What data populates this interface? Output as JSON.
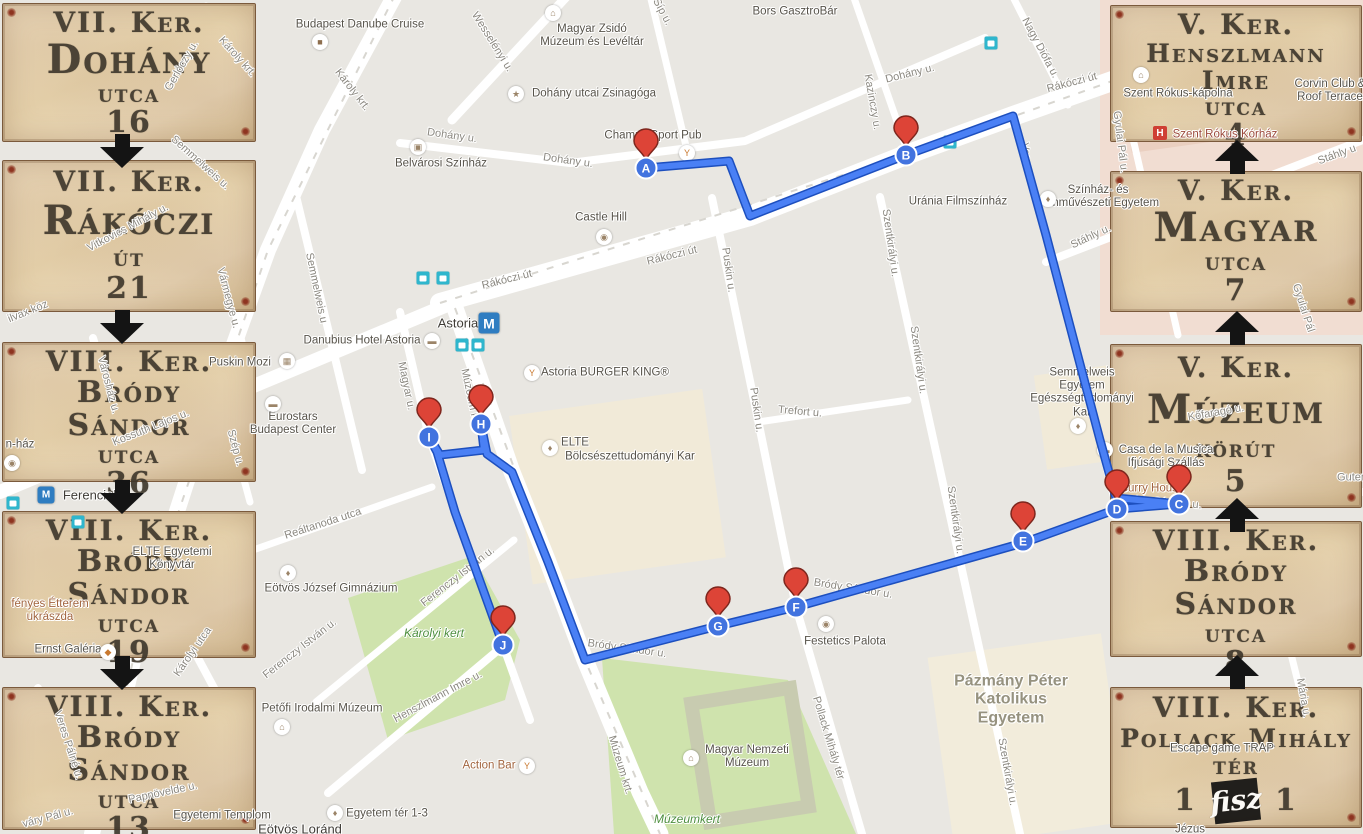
{
  "route": {
    "color": "#4a80f5",
    "casing_color": "#1d4fbe",
    "points": [
      [
        646,
        168
      ],
      [
        729,
        161
      ],
      [
        750,
        216
      ],
      [
        906,
        155
      ],
      [
        1013,
        116
      ],
      [
        1046,
        235
      ],
      [
        1100,
        440
      ],
      [
        1116,
        498
      ],
      [
        1179,
        504
      ],
      [
        1117,
        509
      ],
      [
        1023,
        543
      ],
      [
        796,
        607
      ],
      [
        718,
        626
      ],
      [
        585,
        660
      ],
      [
        548,
        562
      ],
      [
        512,
        472
      ],
      [
        487,
        454
      ],
      [
        481,
        424
      ],
      [
        484,
        450
      ],
      [
        440,
        455
      ],
      [
        429,
        437
      ],
      [
        437,
        452
      ],
      [
        455,
        512
      ],
      [
        503,
        645
      ]
    ],
    "markers": [
      {
        "letter": "A",
        "x": 646,
        "y": 168
      },
      {
        "letter": "B",
        "x": 906,
        "y": 155
      },
      {
        "letter": "C",
        "x": 1179,
        "y": 504
      },
      {
        "letter": "D",
        "x": 1117,
        "y": 509
      },
      {
        "letter": "E",
        "x": 1023,
        "y": 541
      },
      {
        "letter": "F",
        "x": 796,
        "y": 607
      },
      {
        "letter": "G",
        "x": 718,
        "y": 626
      },
      {
        "letter": "H",
        "x": 481,
        "y": 424
      },
      {
        "letter": "I",
        "x": 429,
        "y": 437
      },
      {
        "letter": "J",
        "x": 503,
        "y": 645
      }
    ],
    "marker_pin_color": "#dd4437",
    "marker_circle_color": "#4273df"
  },
  "map": {
    "labels": [
      {
        "t": "Károly krt.",
        "x": 352,
        "y": 90,
        "r": 52,
        "cl": "st"
      },
      {
        "t": "Károly krt.",
        "x": 237,
        "y": 57,
        "r": 48,
        "cl": "st"
      },
      {
        "t": "Wesselényi u.",
        "x": 492,
        "y": 42,
        "r": 58,
        "cl": "st"
      },
      {
        "t": "Síp u.",
        "x": 662,
        "y": 12,
        "r": 62,
        "cl": "st"
      },
      {
        "t": "Dohány u.",
        "x": 452,
        "y": 136,
        "r": 8,
        "cl": "st"
      },
      {
        "t": "Dohány u.",
        "x": 568,
        "y": 161,
        "r": 8,
        "cl": "st"
      },
      {
        "t": "Dohány u.",
        "x": 910,
        "y": 74,
        "r": -14,
        "cl": "st"
      },
      {
        "t": "Kazinczy u.",
        "x": 872,
        "y": 102,
        "r": 80,
        "cl": "st"
      },
      {
        "t": "Nagy Diófa u.",
        "x": 1040,
        "y": 48,
        "r": 62,
        "cl": "st"
      },
      {
        "t": "Rákóczi út",
        "x": 1072,
        "y": 83,
        "r": -15,
        "cl": "st"
      },
      {
        "t": "Rákóczi út",
        "x": 507,
        "y": 280,
        "r": -14,
        "cl": "st"
      },
      {
        "t": "Rákóczi út",
        "x": 672,
        "y": 256,
        "r": -14,
        "cl": "st"
      },
      {
        "t": "Gerlóczy u.",
        "x": 182,
        "y": 66,
        "r": -60,
        "cl": "st"
      },
      {
        "t": "Semmelweis u.",
        "x": 200,
        "y": 163,
        "r": 42,
        "cl": "st"
      },
      {
        "t": "Semmelweis u",
        "x": 316,
        "y": 288,
        "r": 78,
        "cl": "st"
      },
      {
        "t": "Vitkovics Mihály u.",
        "x": 128,
        "y": 228,
        "r": -28,
        "cl": "st"
      },
      {
        "t": "Vármegye u.",
        "x": 228,
        "y": 298,
        "r": 75,
        "cl": "st"
      },
      {
        "t": "ilvax köz",
        "x": 28,
        "y": 312,
        "r": -22,
        "cl": "st"
      },
      {
        "t": "Városház u.",
        "x": 108,
        "y": 385,
        "r": 75,
        "cl": "st"
      },
      {
        "t": "Kossuth Lajos u.",
        "x": 151,
        "y": 428,
        "r": -22,
        "cl": "st"
      },
      {
        "t": "Szép u.",
        "x": 235,
        "y": 448,
        "r": 75,
        "cl": "st"
      },
      {
        "t": "Magyar u.",
        "x": 406,
        "y": 386,
        "r": 78,
        "cl": "st"
      },
      {
        "t": "Múzeum krt",
        "x": 470,
        "y": 397,
        "r": 78,
        "cl": "st"
      },
      {
        "t": "Puskin u.",
        "x": 728,
        "y": 270,
        "r": 82,
        "cl": "st"
      },
      {
        "t": "Puskin u.",
        "x": 756,
        "y": 410,
        "r": 82,
        "cl": "st"
      },
      {
        "t": "Szentkirályi u.",
        "x": 890,
        "y": 243,
        "r": 82,
        "cl": "st"
      },
      {
        "t": "Szentkirályi u.",
        "x": 918,
        "y": 360,
        "r": 82,
        "cl": "st"
      },
      {
        "t": "Szentkirályi u.",
        "x": 955,
        "y": 520,
        "r": 82,
        "cl": "st"
      },
      {
        "t": "Szentkirályi u.",
        "x": 1007,
        "y": 772,
        "r": 80,
        "cl": "st"
      },
      {
        "t": "Trefort u.",
        "x": 800,
        "y": 412,
        "r": 5,
        "cl": "st"
      },
      {
        "t": "Stáhly u.",
        "x": 1091,
        "y": 237,
        "r": -25,
        "cl": "st"
      },
      {
        "t": "Stáhly u",
        "x": 1337,
        "y": 155,
        "r": -20,
        "cl": "st"
      },
      {
        "t": "Vas u.",
        "x": 1026,
        "y": 158,
        "r": 82,
        "cl": "st"
      },
      {
        "t": "Gyulai Pál u.",
        "x": 1120,
        "y": 142,
        "r": 83,
        "cl": "st"
      },
      {
        "t": "Gyulai Pál",
        "x": 1303,
        "y": 308,
        "r": 72,
        "cl": "st"
      },
      {
        "t": "Reáltanoda utca",
        "x": 323,
        "y": 524,
        "r": -18,
        "cl": "st"
      },
      {
        "t": "Ferenczy István u.",
        "x": 458,
        "y": 577,
        "r": -38,
        "cl": "st"
      },
      {
        "t": "Ferenczy István u.",
        "x": 300,
        "y": 649,
        "r": -38,
        "cl": "st"
      },
      {
        "t": "Henszlmann Imre u.",
        "x": 438,
        "y": 697,
        "r": -28,
        "cl": "st"
      },
      {
        "t": "Múzeum krt.",
        "x": 620,
        "y": 765,
        "r": 73,
        "cl": "st"
      },
      {
        "t": "Bródy Sándor u.",
        "x": 853,
        "y": 589,
        "r": 9,
        "cl": "st"
      },
      {
        "t": "Bródy Sándor u.",
        "x": 627,
        "y": 649,
        "r": 8,
        "cl": "st"
      },
      {
        "t": "Bródy Sándor u.",
        "x": 1162,
        "y": 503,
        "r": 4,
        "cl": "st"
      },
      {
        "t": "Pollack Mihály tér",
        "x": 828,
        "y": 738,
        "r": 73,
        "cl": "st"
      },
      {
        "t": "Kőfaragó u.",
        "x": 1216,
        "y": 413,
        "r": -10,
        "cl": "st"
      },
      {
        "t": "Mária u.",
        "x": 1303,
        "y": 698,
        "r": 80,
        "cl": "st"
      },
      {
        "t": "Veres Pálné u.",
        "x": 68,
        "y": 745,
        "r": 72,
        "cl": "st"
      },
      {
        "t": "Papnövelde u.",
        "x": 163,
        "y": 793,
        "r": -12,
        "cl": "st"
      },
      {
        "t": "váry Pál u.",
        "x": 48,
        "y": 818,
        "r": -15,
        "cl": "st"
      },
      {
        "t": "Károlyi utca",
        "x": 193,
        "y": 652,
        "r": -55,
        "cl": "st"
      },
      {
        "t": "Guten",
        "x": 1352,
        "y": 478,
        "r": 0,
        "cl": "st"
      },
      {
        "t": "Budapest Danube Cruise",
        "x": 360,
        "y": 25,
        "r": 0,
        "cl": "poi"
      },
      {
        "t": "Magyar Zsidó\nMúzeum és Levéltár",
        "x": 592,
        "y": 36,
        "r": 0,
        "cl": "poi"
      },
      {
        "t": "Dohány utcai Zsinagóga",
        "x": 594,
        "y": 94,
        "r": 0,
        "cl": "poi"
      },
      {
        "t": "Belvárosi Színház",
        "x": 441,
        "y": 164,
        "r": 0,
        "cl": "poi"
      },
      {
        "t": "Champs Sport Pub",
        "x": 653,
        "y": 136,
        "r": 0,
        "cl": "poi"
      },
      {
        "t": "Bors GasztroBár",
        "x": 795,
        "y": 12,
        "r": 0,
        "cl": "poi"
      },
      {
        "t": "Castle Hill",
        "x": 601,
        "y": 218,
        "r": 0,
        "cl": "poi"
      },
      {
        "t": "Astoria",
        "x": 458,
        "y": 324,
        "r": 0,
        "cl": "station"
      },
      {
        "t": "Danubius Hotel Astoria",
        "x": 362,
        "y": 341,
        "r": 0,
        "cl": "poi"
      },
      {
        "t": "Puskin Mozi",
        "x": 240,
        "y": 363,
        "r": 0,
        "cl": "poi"
      },
      {
        "t": "Eurostars\nBudapest Center",
        "x": 293,
        "y": 424,
        "r": 0,
        "cl": "poi"
      },
      {
        "t": "Astoria BURGER KING®",
        "x": 605,
        "y": 373,
        "r": 0,
        "cl": "poi"
      },
      {
        "t": "Uránia Filmszínház",
        "x": 958,
        "y": 202,
        "r": 0,
        "cl": "poi"
      },
      {
        "t": "Színház- és\nFilmművészeti Egyetem",
        "x": 1098,
        "y": 197,
        "r": 0,
        "cl": "poi"
      },
      {
        "t": "Semmelweis\nEgyetem\nEgészségtudományi\nKar",
        "x": 1082,
        "y": 393,
        "r": 0,
        "cl": "poi"
      },
      {
        "t": "Casa de la Musica\nIfjúsági Szállás",
        "x": 1166,
        "y": 457,
        "r": 0,
        "cl": "poi"
      },
      {
        "t": "Curry House",
        "x": 1152,
        "y": 489,
        "r": 0,
        "cl": "food"
      },
      {
        "t": "ELTE",
        "x": 575,
        "y": 443,
        "r": 0,
        "cl": "poi"
      },
      {
        "t": "Bölcsészettudományi Kar",
        "x": 630,
        "y": 457,
        "r": 0,
        "cl": "poi"
      },
      {
        "t": "Eötvös József Gimnázium",
        "x": 331,
        "y": 589,
        "r": 0,
        "cl": "poi"
      },
      {
        "t": "Károlyi kert",
        "x": 434,
        "y": 634,
        "r": 0,
        "cl": "park"
      },
      {
        "t": "ELTE Egyetemi\nKönyvtár",
        "x": 172,
        "y": 559,
        "r": 0,
        "cl": "poi"
      },
      {
        "t": "fényes Étterem\nukrászda",
        "x": 50,
        "y": 611,
        "r": 0,
        "cl": "food"
      },
      {
        "t": "Ernst Galéria",
        "x": 68,
        "y": 650,
        "r": 0,
        "cl": "poi"
      },
      {
        "t": "Ferenciek t",
        "x": 95,
        "y": 496,
        "r": 0,
        "cl": "station"
      },
      {
        "t": "n-ház",
        "x": 20,
        "y": 445,
        "r": 0,
        "cl": "poi"
      },
      {
        "t": "Festetics Palota",
        "x": 845,
        "y": 642,
        "r": 0,
        "cl": "poi"
      },
      {
        "t": "Pázmány Péter\nKatolikus\nEgyetem",
        "x": 1011,
        "y": 700,
        "r": 0,
        "cl": "area"
      },
      {
        "t": "Magyar Nemzeti\nMúzeum",
        "x": 747,
        "y": 757,
        "r": 0,
        "cl": "poi"
      },
      {
        "t": "Múzeumkert",
        "x": 687,
        "y": 820,
        "r": 0,
        "cl": "park"
      },
      {
        "t": "Petőfi Irodalmi Múzeum",
        "x": 322,
        "y": 709,
        "r": 0,
        "cl": "poi"
      },
      {
        "t": "Action Bar",
        "x": 489,
        "y": 766,
        "r": 0,
        "cl": "food"
      },
      {
        "t": "Egyetem tér 1-3",
        "x": 387,
        "y": 814,
        "r": 0,
        "cl": "poi"
      },
      {
        "t": "Egyetemi Templom",
        "x": 222,
        "y": 816,
        "r": 0,
        "cl": "poi"
      },
      {
        "t": "Eötvös Loránd",
        "x": 300,
        "y": 830,
        "r": 0,
        "cl": "station"
      },
      {
        "t": "Szent Rókus-kápolna",
        "x": 1178,
        "y": 94,
        "r": 0,
        "cl": "poi"
      },
      {
        "t": "Szent Rókus Kórház",
        "x": 1225,
        "y": 135,
        "r": 0,
        "cl": "hosp"
      },
      {
        "t": "Corvin Club &\nRoof Terrace",
        "x": 1330,
        "y": 91,
        "r": 0,
        "cl": "poi"
      },
      {
        "t": "Escape game TRAP",
        "x": 1222,
        "y": 749,
        "r": 0,
        "cl": "poi"
      },
      {
        "t": "Jézus",
        "x": 1190,
        "y": 830,
        "r": 0,
        "cl": "poi"
      }
    ],
    "icons": [
      {
        "name": "cruise-icon",
        "k": "poi",
        "g": "■",
        "x": 320,
        "y": 42,
        "c": "#8d6e4e"
      },
      {
        "name": "museum-icon",
        "k": "poi",
        "g": "⌂",
        "x": 553,
        "y": 13
      },
      {
        "name": "synagogue-icon",
        "k": "poi",
        "g": "★",
        "x": 516,
        "y": 94
      },
      {
        "name": "theater-icon",
        "k": "poi",
        "g": "▣",
        "x": 418,
        "y": 147
      },
      {
        "name": "pub-icon",
        "k": "poi",
        "g": "Y",
        "x": 687,
        "y": 153,
        "c": "#c9792f"
      },
      {
        "name": "camera-icon",
        "k": "poi",
        "g": "◉",
        "x": 604,
        "y": 237
      },
      {
        "name": "hotel-icon",
        "k": "poi",
        "g": "▬",
        "x": 432,
        "y": 341
      },
      {
        "name": "hotel-icon",
        "k": "poi",
        "g": "▬",
        "x": 273,
        "y": 404
      },
      {
        "name": "cinema-icon",
        "k": "poi",
        "g": "▦",
        "x": 287,
        "y": 361
      },
      {
        "name": "restaurant-icon",
        "k": "poi",
        "g": "Y",
        "x": 532,
        "y": 373,
        "c": "#c9792f"
      },
      {
        "name": "university-icon",
        "k": "poi",
        "g": "♦",
        "x": 550,
        "y": 448
      },
      {
        "name": "school-icon",
        "k": "poi",
        "g": "♦",
        "x": 288,
        "y": 573
      },
      {
        "name": "university-icon",
        "k": "poi",
        "g": "♦",
        "x": 335,
        "y": 813
      },
      {
        "name": "university-icon",
        "k": "poi",
        "g": "♦",
        "x": 1048,
        "y": 199
      },
      {
        "name": "university-icon",
        "k": "poi",
        "g": "♦",
        "x": 1078,
        "y": 426
      },
      {
        "name": "camera-icon",
        "k": "poi",
        "g": "◉",
        "x": 826,
        "y": 624
      },
      {
        "name": "museum-icon",
        "k": "poi",
        "g": "⌂",
        "x": 691,
        "y": 758
      },
      {
        "name": "museum-icon",
        "k": "poi",
        "g": "⌂",
        "x": 282,
        "y": 727
      },
      {
        "name": "bar-icon",
        "k": "poi",
        "g": "Y",
        "x": 527,
        "y": 766,
        "c": "#c9792f"
      },
      {
        "name": "camera-icon",
        "k": "poi",
        "g": "◉",
        "x": 12,
        "y": 463
      },
      {
        "name": "church-icon",
        "k": "poi",
        "g": "⌂",
        "x": 1141,
        "y": 75
      },
      {
        "name": "hospital-icon",
        "k": "hosp",
        "g": "H",
        "x": 1160,
        "y": 133
      },
      {
        "name": "gallery-icon",
        "k": "poi",
        "g": "◆",
        "x": 108,
        "y": 652,
        "c": "#c9792f"
      },
      {
        "name": "hotel-icon",
        "k": "poi",
        "g": "▬",
        "x": 1105,
        "y": 450
      },
      {
        "name": "metro-icon",
        "k": "metro",
        "g": "M",
        "x": 489,
        "y": 323,
        "s": 21
      },
      {
        "name": "metro-icon",
        "k": "metro",
        "g": "M",
        "x": 46,
        "y": 495,
        "s": 17
      },
      {
        "name": "tram-icon",
        "k": "tram",
        "g": "",
        "x": 423,
        "y": 278
      },
      {
        "name": "bus-icon",
        "k": "bus",
        "g": "",
        "x": 443,
        "y": 278
      },
      {
        "name": "tram-icon",
        "k": "tram",
        "g": "",
        "x": 462,
        "y": 345
      },
      {
        "name": "bus-icon",
        "k": "bus",
        "g": "",
        "x": 478,
        "y": 345
      },
      {
        "name": "bus-icon",
        "k": "bus",
        "g": "",
        "x": 991,
        "y": 43
      },
      {
        "name": "tram-icon",
        "k": "tram",
        "g": "",
        "x": 950,
        "y": 142
      },
      {
        "name": "bus-icon",
        "k": "bus",
        "g": "",
        "x": 13,
        "y": 503
      },
      {
        "name": "bus-icon",
        "k": "bus",
        "g": "",
        "x": 78,
        "y": 522
      }
    ]
  },
  "panels": {
    "paper_color": "#e8d6b2",
    "text_color": "#3c352a",
    "left": {
      "arrow_direction": "down",
      "items": [
        {
          "district": "VII. Ker.",
          "street": "Dohány",
          "type": "utca",
          "number": "16"
        },
        {
          "district": "VII. Ker.",
          "street": "Rákóczi",
          "type": "út",
          "number": "21"
        },
        {
          "district": "VIII. Ker.",
          "street": "Bródy Sándor",
          "type": "utca",
          "number": "36"
        },
        {
          "district": "VIII. Ker.",
          "street": "Bródy Sándor",
          "type": "utca",
          "number": "19"
        },
        {
          "district": "VIII. Ker.",
          "street": "Bródy Sándor",
          "type": "utca",
          "number": "13"
        }
      ]
    },
    "right": {
      "arrow_direction": "up",
      "items": [
        {
          "district": "V. Ker.",
          "street": "Henszlmann Imre",
          "type": "utca",
          "number": "4"
        },
        {
          "district": "V. Ker.",
          "street": "Magyar",
          "type": "utca",
          "number": "7"
        },
        {
          "district": "V. Ker.",
          "street": "Múzeum",
          "type": "körút",
          "number": "5"
        },
        {
          "district": "VIII. Ker.",
          "street": "Bródy Sándor",
          "type": "utca",
          "number": "8"
        },
        {
          "district": "VIII. Ker.",
          "street": "Pollack Mihály",
          "type": "tér",
          "number_left": "1",
          "number_right": "1",
          "logo": "fisz"
        }
      ]
    }
  }
}
